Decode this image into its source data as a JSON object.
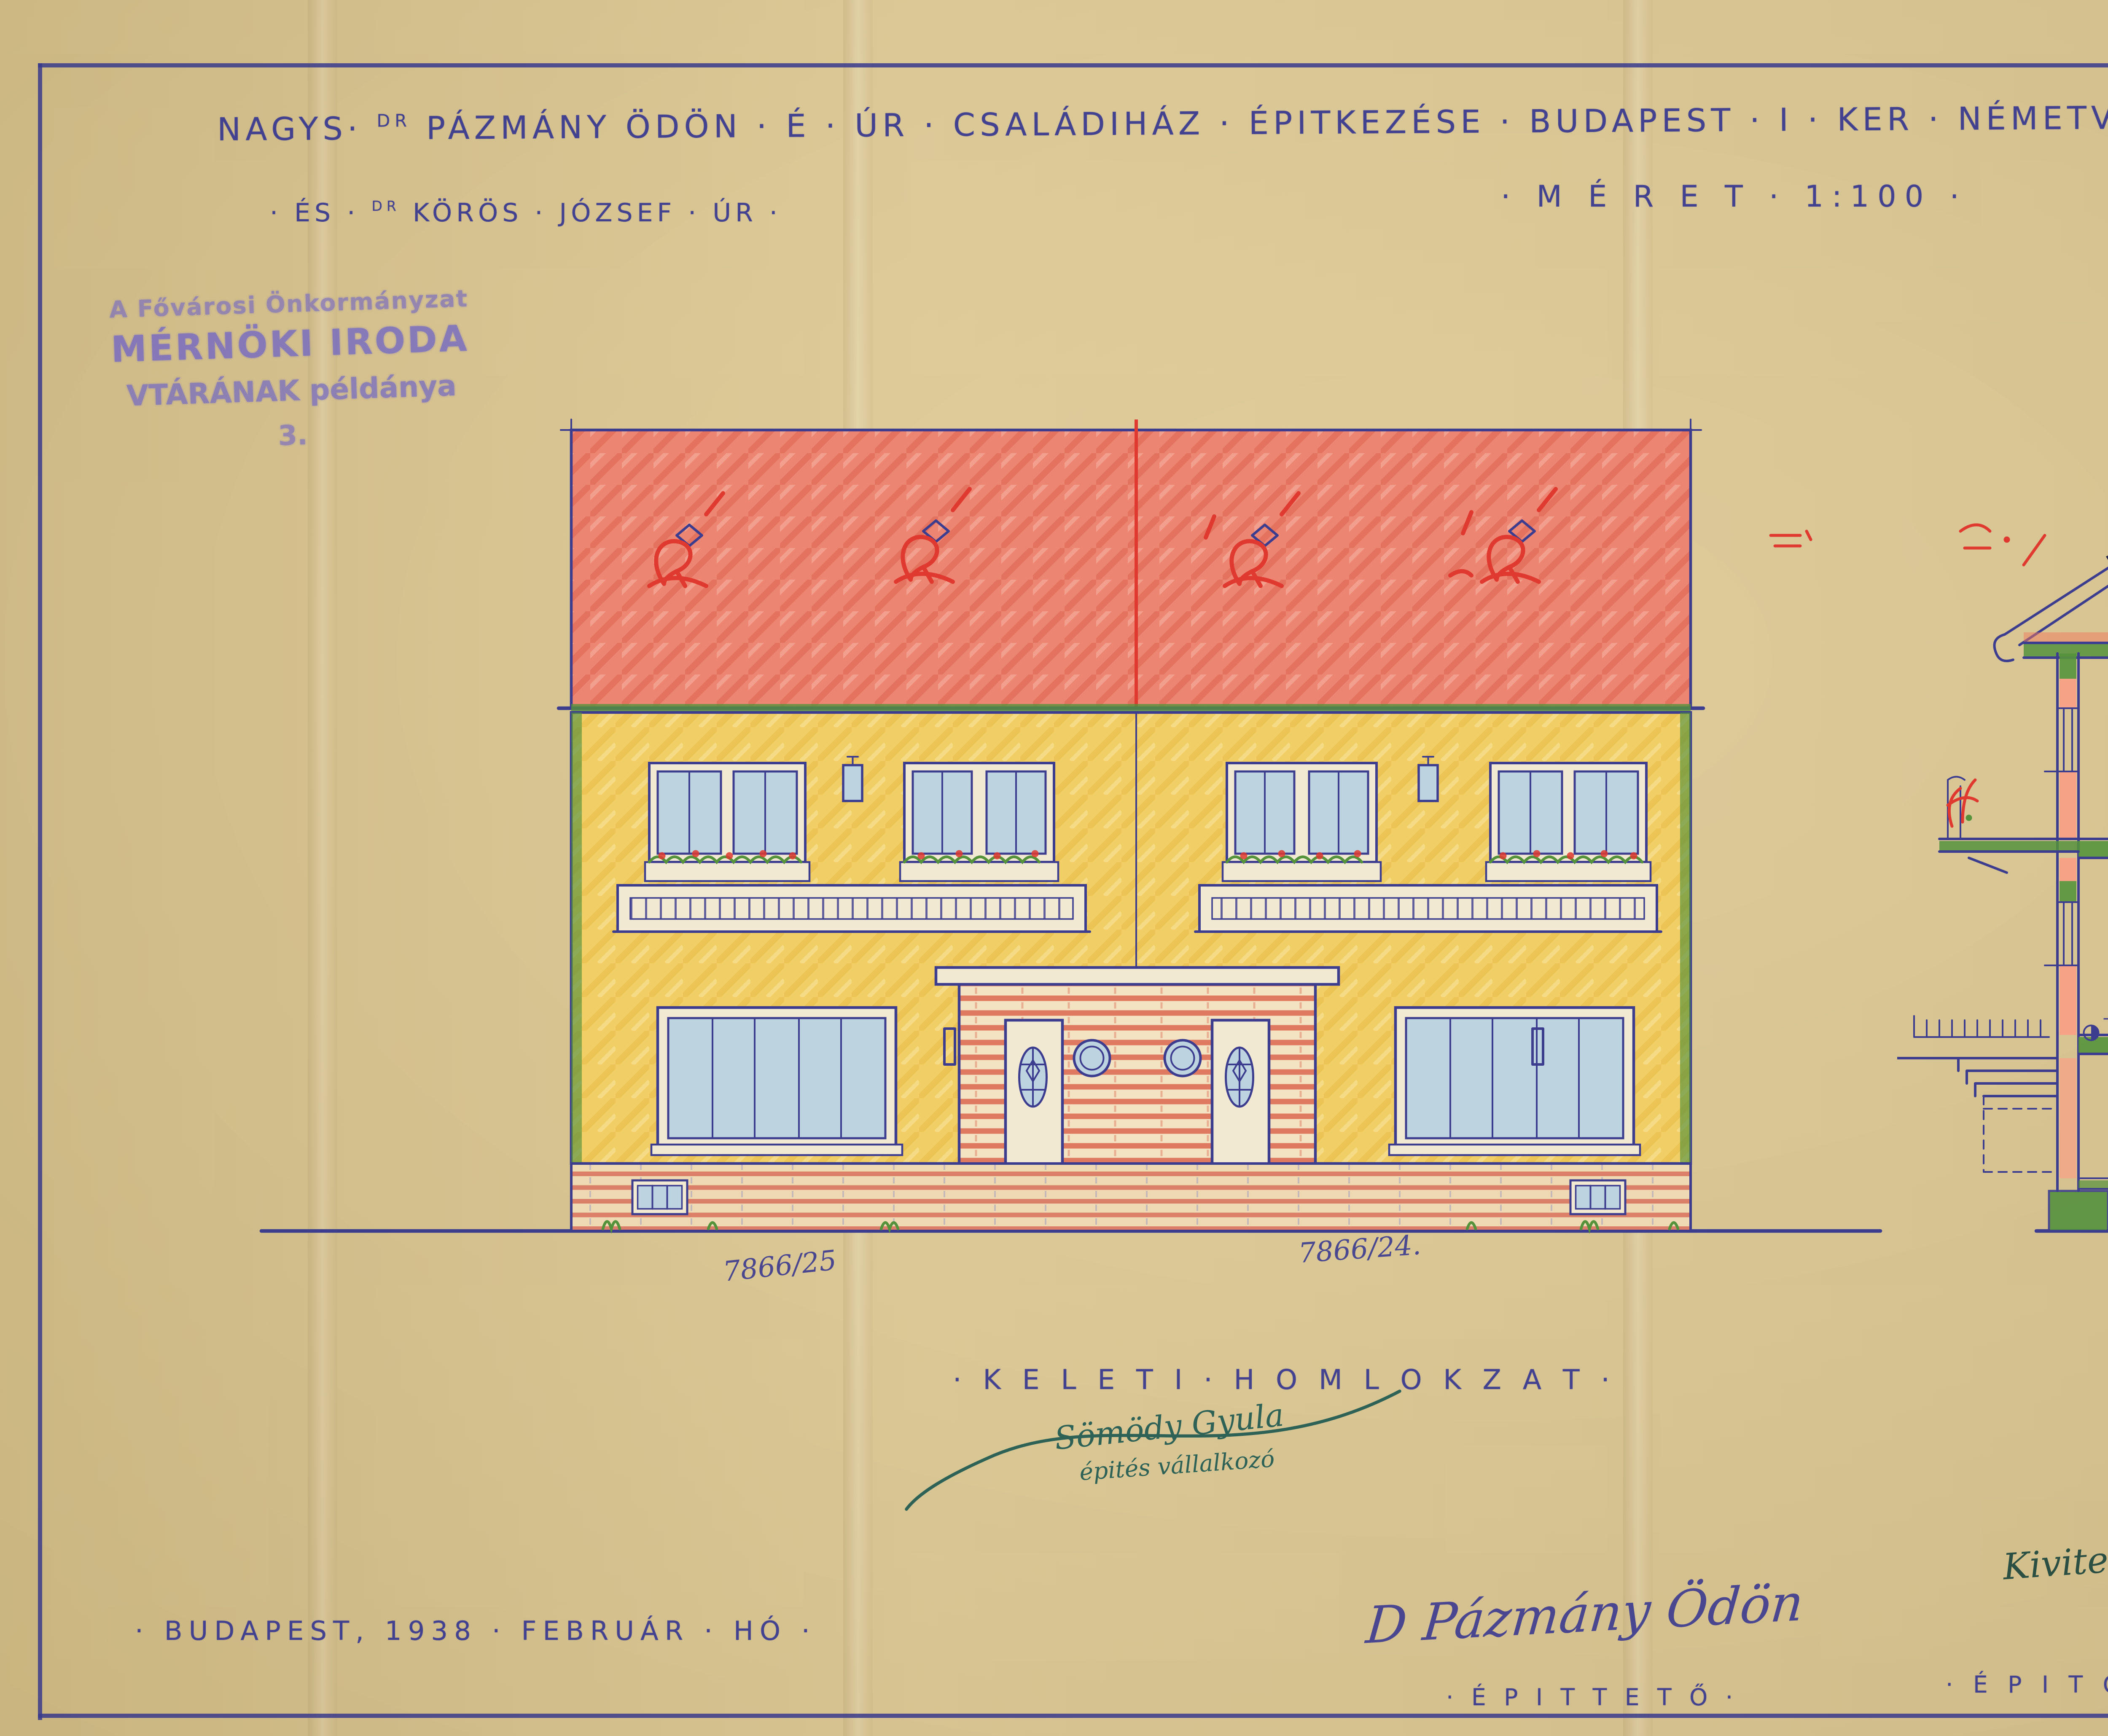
{
  "colors": {
    "paper": "#dcc893",
    "ink": "#3d3d90",
    "red": "#e0392f",
    "roof_red": "#ec8672",
    "facade_yellow": "#f2cf66",
    "slab_green": "#55923c",
    "wall_salmon": "#f5a287",
    "glass_blue": "#bed3e0",
    "stamp_purple": "#7b6fbe",
    "signature_teal": "#2f6257",
    "signature_lightblue": "#85b8d8",
    "black": "#1c1c1c"
  },
  "header": {
    "nagys": "NAGYS·",
    "dr1": "DR",
    "main": "PÁZMÁNY ÖDÖN · É · ÚR · CSALÁDIHÁZ · ÉPITKEZÉSE · BUDAPEST · I · KER · NÉMETVÖLGYIDÜLŐ · NÉVTELEN · UCCA · 7866/24",
    "suffix": "UJ · HRSZ · ALATT ·",
    "parcel_alt": "7866/25",
    "and_prefix": "· ÉS ·",
    "dr2": "DR",
    "line2_rest": "KÖRÖS · JÓZSEF · ÚR ·",
    "scale_label": "· M É R E T · 1:100 ·",
    "corner_mark": "3"
  },
  "archive": {
    "name": "Budapest Főváros Levéltára"
  },
  "office_stamp": {
    "line1": "A Fővárosi Önkormányzat",
    "line2": "MÉRNÖKI IRODA",
    "line3": "VTÁRÁNAK példánya",
    "line4": "3."
  },
  "elevation": {
    "parcel_left": "7866/25",
    "parcel_right": "7866/24.",
    "label": "· K E L E T I · H O M L O K Z A T ·",
    "contractor_signature": "Sömödy Gyula",
    "contractor_role": "épités vállalkozó"
  },
  "section": {
    "label": "· M E T S Z E T ·",
    "dims": {
      "attic_slab": "0.35.",
      "upper_room": "3.00.",
      "upper_slab": "0.35",
      "ground_room": "3.10.",
      "ground_slab": "0.30",
      "entry_level": "+0.80",
      "basement_room": "2.20.",
      "parapet_upper": "1.10",
      "parapet_ground": "1.10",
      "slab_right": "0.30.",
      "basement_right": "0.60.",
      "chimney_old": "0.90",
      "chimney_new": "0.80",
      "roof_height": "4.00",
      "total_height": "7.50.",
      "red_bracket": "1.00",
      "red_arrow": "100"
    },
    "timber": {
      "ridge": "10/13",
      "rafter": "2×6/13",
      "strut_a": "15/15",
      "strut_b": "15/15",
      "strut_c": "15/15",
      "tie_beam": "18/24"
    }
  },
  "footer": {
    "date": "· BUDAPEST, 1938 · FEBRUÁR · HÓ ·",
    "client_signature": "D Pázmány Ödön",
    "client_role": "· É P I T T E T Ő ·",
    "master_role": "· É P I T Ő M E S T E R · ·",
    "responsible_note": "Kivitelezésért felelős",
    "builder_signature": "Kis Albert",
    "builder_stamp": {
      "name": "KIS ALBERT",
      "title": "építészmérnök, építőmester",
      "city": "BUDAPEST",
      "address": "IX., Üllői-út 21. T. 1:34-061."
    },
    "designer_label": "Tervező :",
    "designer_signature": "Koromzai Vilmos",
    "designer_role": "É P I T É S Z M É R N Ö K",
    "designer_address": "Bp. I. Nárcisz u. 14."
  }
}
